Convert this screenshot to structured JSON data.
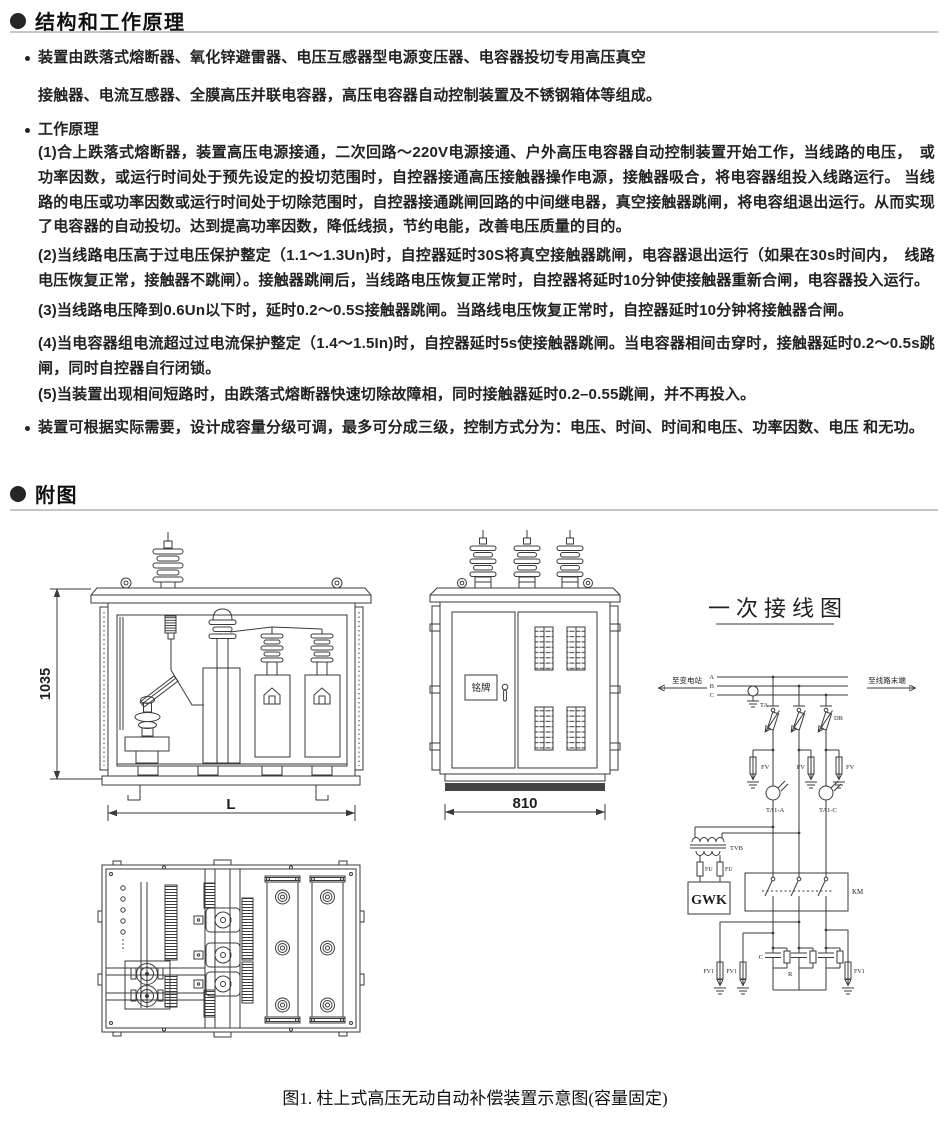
{
  "sections": {
    "principle": {
      "title": "结构和工作原理",
      "items": [
        {
          "kind": "bullet",
          "text": "装置由跌落式熔断器、氧化锌避雷器、电压互感器型电源变压器、电容器投切专用高压真空"
        },
        {
          "kind": "cont",
          "text": "接触器、电流互感器、全膜高压并联电容器，高压电容器自动控制装置及不锈钢箱体等组成。"
        },
        {
          "kind": "bullet",
          "text": "工作原理"
        },
        {
          "kind": "para",
          "text": "(1)合上跌落式熔断器，装置高压电源接通，二次回路～220V电源接通、户外高压电容器自动控制装置开始工作，当线路的电压，　或功率因数，或运行时间处于预先设定的投切范围时，自控器接通高压接触器操作电源，接触器吸合，将电容器组投入线路运行。 当线路的电压或功率因数或运行时间处于切除范围时，自控器接通跳闸回路的中间继电器，真空接触器跳闸，将电容组退出运行。从而实现了电容器的自动投切。达到提高功率因数，降低线损，节约电能，改善电压质量的目的。"
        },
        {
          "kind": "para",
          "text": "(2)当线路电压高于过电压保护整定（1.1～1.3Un)时，自控器延时30S将真空接触器跳闸，电容器退出运行（如果在30s时间内，　线路电压恢复正常，接触器不跳闸）。接触器跳闸后，当线路电压恢复正常时，自控器将延时10分钟使接触器重新合闸，电容器投入运行。"
        },
        {
          "kind": "para",
          "text": "(3)当线路电压降到0.6Un以下时，延时0.2～0.5S接触器跳闸。当路线电压恢复正常时，自控器延时10分钟将接触器合闸。"
        },
        {
          "kind": "para",
          "text": "(4)当电容器组电流超过过电流保护整定（1.4～1.5In)时，自控器延时5s使接触器跳闸。当电容器相间击穿时，接触器延时0.2～0.5s跳闸，同时自控器自行闭锁。"
        },
        {
          "kind": "para",
          "text": "(5)当装置出现相间短路时，由跌落式熔断器快速切除故障相，同时接触器延时0.2–0.55跳闸，并不再投入。"
        },
        {
          "kind": "bullet",
          "text": "装置可根据实际需要，设计成容量分级可调，最多可分成三级，控制方式分为：电压、时间、时间和电压、功率因数、电压 和无功。"
        }
      ]
    },
    "figures": {
      "title": "附图",
      "caption": "图1. 柱上式高压无动自动补偿装置示意图(容量固定)"
    }
  },
  "front_view": {
    "dim_height": "1035",
    "dim_length": "L"
  },
  "side_view": {
    "nameplate": "铭牌",
    "dim_width": "810"
  },
  "schematic": {
    "title": "一次接线图",
    "to_substation": "至变电站",
    "to_line_end": "至线路末端",
    "phase_a": "A",
    "phase_b": "B",
    "phase_c": "C",
    "ta": "TA",
    "dr": "DR",
    "fv": "FV",
    "ta1_a": "TA1-A",
    "ta1_c": "TA1-C",
    "tvb": "TVB",
    "fu": "FU",
    "gwk": "GWK",
    "km": "KM",
    "cap": "C",
    "res": "R",
    "fv1": "FV1"
  },
  "colors": {
    "ink": "#3a3a3a",
    "text": "#1d1d1d",
    "rule": "#c6c6c6"
  }
}
